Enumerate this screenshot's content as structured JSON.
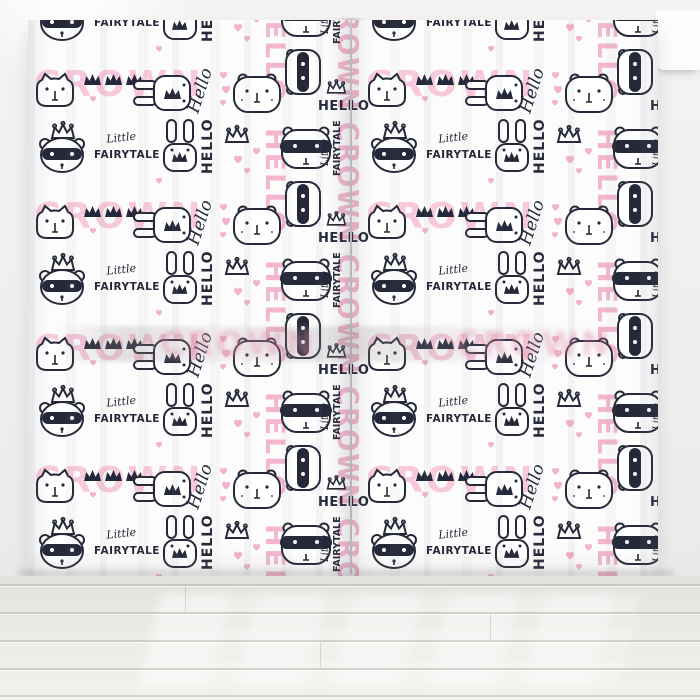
{
  "scene": {
    "description": "Two sheer white curtain panels printed with a pink and black fairytale pattern, hanging in a bright room over a whitewashed wooden floor"
  },
  "pattern": {
    "words": {
      "crown": "CROWN",
      "hello_caps": "HELLO",
      "hello_script": "Hello",
      "little": "Little",
      "fairytale": "FAIRYTALE"
    },
    "colors": {
      "pink_text": "#f2b7cd",
      "pink_light": "#f7c9da",
      "heart_pink": "#f3b3ca",
      "ink": "#242838",
      "fabric": "#fdfcfc"
    },
    "motifs": [
      "raccoon-face",
      "cat-face",
      "bunny-face",
      "bear-face",
      "crown-solid",
      "crown-outline",
      "heart"
    ]
  },
  "room": {
    "wall_color": "#f1f0ee",
    "floor_color": "#e8e6e2"
  }
}
